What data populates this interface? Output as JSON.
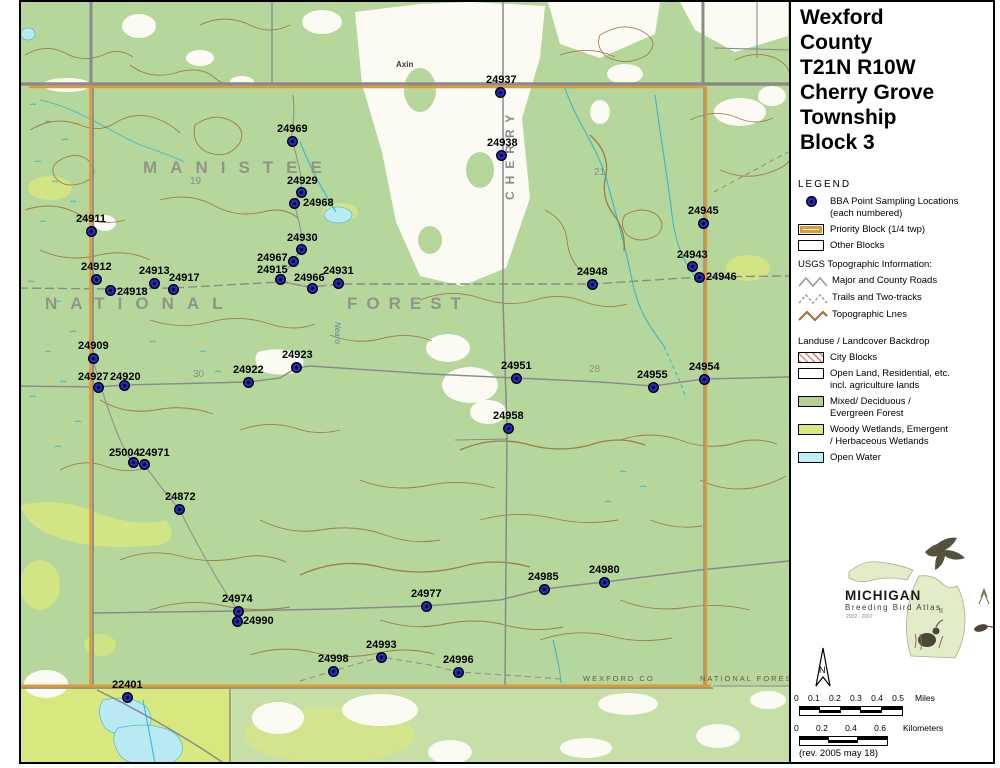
{
  "title": {
    "lines": [
      "Wexford",
      "County",
      "T21N R10W",
      "Cherry Grove",
      "Township",
      "Block 3"
    ]
  },
  "legend": {
    "heading": "LEGEND",
    "bba_line1": "BBA Point Sampling Locations",
    "bba_line2": "(each numbered)",
    "priority_block": "Priority Block (1/4 twp)",
    "other_blocks": "Other Blocks",
    "usgs_heading": "USGS Topographic Information:",
    "roads": "Major and County Roads",
    "trails": "Trails and Two-tracks",
    "topo": "Topographic Lnes",
    "landuse_heading": "Landuse / Landcover Backdrop",
    "city_blocks": "City Blocks",
    "open_land_1": "Open Land, Residential, etc.",
    "open_land_2": "incl. agriculture lands",
    "forest_1": "Mixed/ Deciduous /",
    "forest_2": "Evergreen Forest",
    "wetland_1": "Woody Wetlands, Emergent",
    "wetland_2": "/ Herbaceous Wetlands",
    "open_water": "Open Water"
  },
  "logo": {
    "name": "MICHIGAN",
    "subtitle": "Breeding Bird Atlas",
    "years": "2002 - 2007",
    "numeral": "II"
  },
  "north_label": "N",
  "scale_miles": {
    "ticks": [
      "0",
      "0.1",
      "0.2",
      "0.3",
      "0.4",
      "0.5"
    ],
    "unit": "Miles"
  },
  "scale_km": {
    "ticks": [
      "0",
      "0.2",
      "0.4",
      "0.6"
    ],
    "unit": "Kilometers"
  },
  "revision": "(rev. 2005 may 18)",
  "colors": {
    "forest_green": "#b6d79c",
    "wetland_green": "#d9e87e",
    "open_water": "#c2eef5",
    "priority_orange": "#e09a34",
    "contour_brown": "#9d6b33",
    "road_gray": "#8a8a8a",
    "point_blue": "#2626c0"
  },
  "map": {
    "points": [
      {
        "id": "24937",
        "x": 500,
        "y": 92,
        "lx": 486,
        "ly": 75
      },
      {
        "id": "24969",
        "x": 292,
        "y": 141,
        "lx": 277,
        "ly": 124
      },
      {
        "id": "24938",
        "x": 501,
        "y": 155,
        "lx": 487,
        "ly": 138
      },
      {
        "id": "24929",
        "x": 301,
        "y": 192,
        "lx": 287,
        "ly": 176
      },
      {
        "id": "24968",
        "x": 294,
        "y": 203,
        "lx": 303,
        "ly": 198
      },
      {
        "id": "24911",
        "x": 91,
        "y": 231,
        "lx": 76,
        "ly": 214
      },
      {
        "id": "24945",
        "x": 703,
        "y": 223,
        "lx": 688,
        "ly": 206
      },
      {
        "id": "24930",
        "x": 301,
        "y": 249,
        "lx": 287,
        "ly": 233
      },
      {
        "id": "24967",
        "x": 293,
        "y": 261,
        "lx": 257,
        "ly": 253
      },
      {
        "id": "24912",
        "x": 96,
        "y": 279,
        "lx": 81,
        "ly": 262
      },
      {
        "id": "24913",
        "x": 154,
        "y": 283,
        "lx": 139,
        "ly": 266
      },
      {
        "id": "24917",
        "x": 173,
        "y": 289,
        "lx": 169,
        "ly": 273
      },
      {
        "id": "24915",
        "x": 280,
        "y": 279,
        "lx": 257,
        "ly": 265
      },
      {
        "id": "24943",
        "x": 692,
        "y": 266,
        "lx": 677,
        "ly": 250
      },
      {
        "id": "24946",
        "x": 699,
        "y": 277,
        "lx": 706,
        "ly": 272
      },
      {
        "id": "24966",
        "x": 312,
        "y": 288,
        "lx": 294,
        "ly": 273
      },
      {
        "id": "24931",
        "x": 338,
        "y": 283,
        "lx": 323,
        "ly": 266
      },
      {
        "id": "24948",
        "x": 592,
        "y": 284,
        "lx": 577,
        "ly": 267
      },
      {
        "id": "24918",
        "x": 110,
        "y": 290,
        "lx": 117,
        "ly": 287
      },
      {
        "id": "24909",
        "x": 93,
        "y": 358,
        "lx": 78,
        "ly": 341
      },
      {
        "id": "24923",
        "x": 296,
        "y": 367,
        "lx": 282,
        "ly": 350
      },
      {
        "id": "24927",
        "x": 98,
        "y": 387,
        "lx": 78,
        "ly": 372
      },
      {
        "id": "24920",
        "x": 124,
        "y": 385,
        "lx": 110,
        "ly": 372
      },
      {
        "id": "24922",
        "x": 248,
        "y": 382,
        "lx": 233,
        "ly": 365
      },
      {
        "id": "24951",
        "x": 516,
        "y": 378,
        "lx": 501,
        "ly": 361
      },
      {
        "id": "24955",
        "x": 653,
        "y": 387,
        "lx": 637,
        "ly": 370
      },
      {
        "id": "24954",
        "x": 704,
        "y": 379,
        "lx": 689,
        "ly": 362
      },
      {
        "id": "24958",
        "x": 508,
        "y": 428,
        "lx": 493,
        "ly": 411
      },
      {
        "id": "25004",
        "x": 133,
        "y": 462,
        "lx": 109,
        "ly": 448
      },
      {
        "id": "24971",
        "x": 144,
        "y": 464,
        "lx": 139,
        "ly": 448
      },
      {
        "id": "24872",
        "x": 179,
        "y": 509,
        "lx": 165,
        "ly": 492
      },
      {
        "id": "24985",
        "x": 544,
        "y": 589,
        "lx": 528,
        "ly": 572
      },
      {
        "id": "24980",
        "x": 604,
        "y": 582,
        "lx": 589,
        "ly": 565
      },
      {
        "id": "24977",
        "x": 426,
        "y": 606,
        "lx": 411,
        "ly": 589
      },
      {
        "id": "24974",
        "x": 238,
        "y": 611,
        "lx": 222,
        "ly": 594
      },
      {
        "id": "24990",
        "x": 237,
        "y": 621,
        "lx": 243,
        "ly": 616
      },
      {
        "id": "24993",
        "x": 381,
        "y": 657,
        "lx": 366,
        "ly": 640
      },
      {
        "id": "24998",
        "x": 333,
        "y": 671,
        "lx": 318,
        "ly": 654
      },
      {
        "id": "24996",
        "x": 458,
        "y": 672,
        "lx": 443,
        "ly": 655
      },
      {
        "id": "22401",
        "x": 127,
        "y": 697,
        "lx": 112,
        "ly": 680
      }
    ],
    "big_labels": [
      {
        "text": "MANISTEE",
        "x": 143,
        "y": 158,
        "fs": 17,
        "ls": 13
      },
      {
        "text": "NATIONAL",
        "x": 45,
        "y": 294,
        "fs": 17,
        "ls": 13
      },
      {
        "text": "FOREST",
        "x": 347,
        "y": 294,
        "fs": 17,
        "ls": 9
      }
    ],
    "small_labels": [
      {
        "text": "Axin",
        "x": 396,
        "y": 60,
        "cls": "tiny-dark"
      },
      {
        "text": "WEXFORD  CO",
        "x": 583,
        "y": 674,
        "cls": "tiny-brown"
      },
      {
        "text": "NATIONAL  FOREST",
        "x": 700,
        "y": 674,
        "cls": "tiny-brown"
      },
      {
        "text": "19",
        "x": 190,
        "y": 176,
        "cls": "section"
      },
      {
        "text": "21",
        "x": 594,
        "y": 167,
        "cls": "section"
      },
      {
        "text": "30",
        "x": 193,
        "y": 369,
        "cls": "section"
      },
      {
        "text": "28",
        "x": 589,
        "y": 364,
        "cls": "section"
      },
      {
        "text": "CHERRY",
        "x": 503,
        "y": 52,
        "cls": "vroad"
      },
      {
        "text": "Nearo",
        "x": 333,
        "y": 322,
        "cls": "vcreek"
      }
    ]
  }
}
